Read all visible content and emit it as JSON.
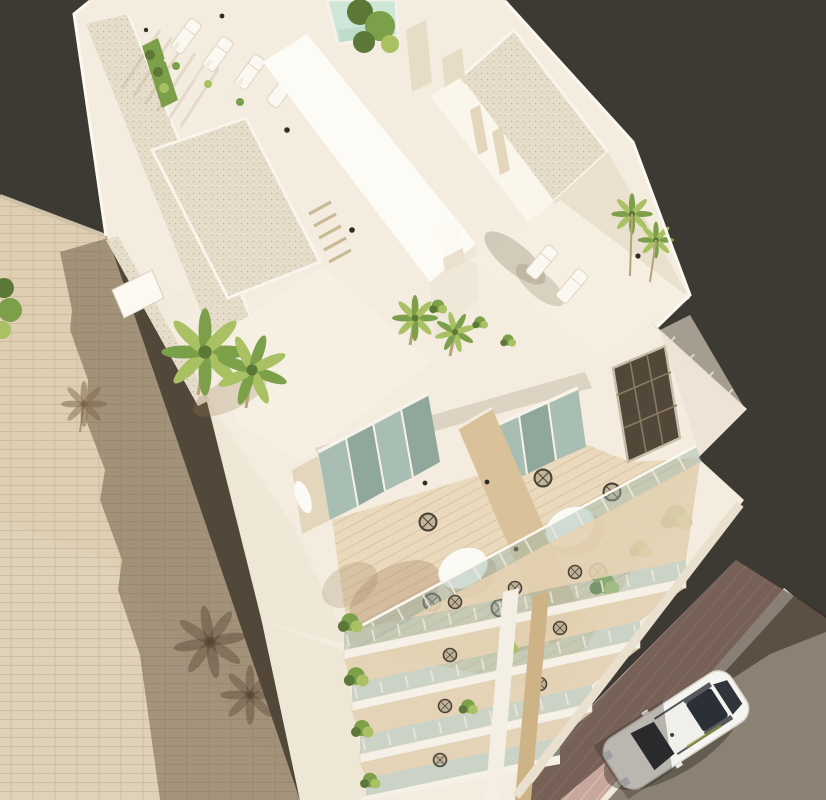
{
  "meta": {
    "title": "Aerial 3D architectural rendering of a white residential building",
    "image_type": "3d-architectural-render",
    "view": "aerial-oblique",
    "has_text": false
  },
  "scene": {
    "building": {
      "style": "modern white multi-storey apartment block",
      "rooftop_features": [
        "gravel roof borders",
        "sun loungers",
        "hedge planter",
        "plunge pool",
        "stair core slab",
        "palm trees",
        "louvre vent",
        "wall lights"
      ],
      "terrace_level_features": [
        "two dining terraces",
        "round white tables",
        "black wire chairs",
        "light wood divider wall",
        "sliding glass doors",
        "glass balustrade",
        "dark grid entry door",
        "planter shrubs"
      ],
      "lower_level_features": [
        "four stacked balcony floors",
        "glass railings",
        "bistro chairs",
        "green planters",
        "wood divider stack"
      ]
    },
    "surroundings": {
      "left": "adjacent beige brick party wall with cast shadow of the building and palm trees",
      "bottom_right": [
        "pink tiled sidewalk with white curb",
        "asphalt street",
        "parked white sedan seen from above"
      ],
      "background": "dark olive neutral backdrop"
    },
    "counts": {
      "rooftop_loungers": 6,
      "terrace_tables": 2,
      "terrace_chairs": 6,
      "palm_clusters": 4,
      "balcony_levels": 4,
      "cars": 1
    }
  },
  "palette": {
    "background": "#3d3a33",
    "wallLight": "#f3ecdf",
    "wallBright": "#fcf9f2",
    "wallShade": "#e9e0ce",
    "wallDark": "#dbd0ba",
    "gravel": "#e6ddcb",
    "gravelDot": "#c8bca6",
    "brickLit": "#decfb3",
    "brickLitWarm": "#e2d2c2",
    "brickShadow": "rgba(104,86,66,0.50)",
    "brickLine": "rgba(125,102,76,0.18)",
    "woodWall": "#d9c19a",
    "woodBeam": "#cdb386",
    "terraceFloor": "#ead9bc",
    "plankLine": "rgba(146,116,76,0.20)",
    "glassFill": "rgba(156,182,170,0.45)",
    "glassDoor": "#a9beb2",
    "glassDoorDark": "#90a79b",
    "mullion": "#f7f3e9",
    "doorDark": "#52483a",
    "doorGrid": "#8a7a5f",
    "greenDark": "#5c7837",
    "green": "#7ca049",
    "greenLight": "#a9c163",
    "trunk": "#b5a478",
    "pool": "#cde6d8",
    "street": "#8c8273",
    "sidewalk": "#c7a69c",
    "curb": "#efe8db",
    "streetShadow": "rgba(52,40,31,0.55)",
    "carBody": "#f6f4f0",
    "carGlass": "#272b32",
    "carTrim": "#d9d5cc",
    "shadowSoft": "rgba(150,118,82,0.28)",
    "lightDot": "#2f2b23",
    "edgeHighlight": "#fbf8f0"
  }
}
